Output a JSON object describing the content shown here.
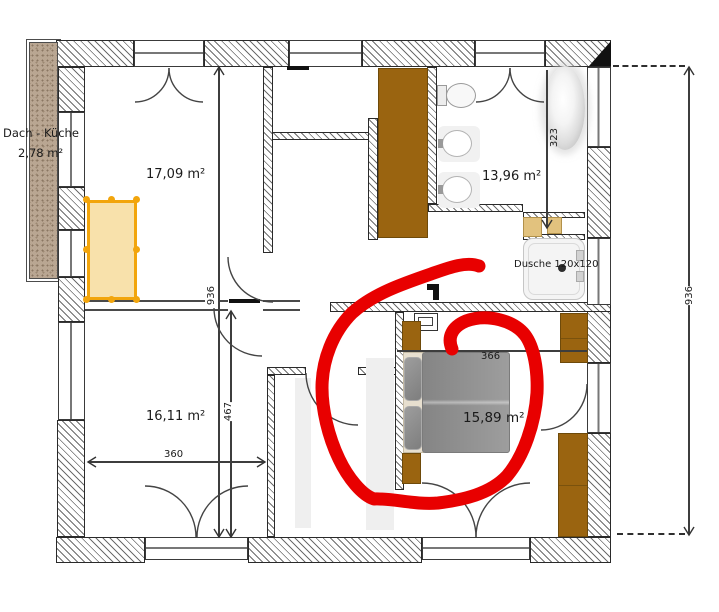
{
  "rooms": {
    "attic_label": "Dach - Küche",
    "attic_area": "2,78 m²",
    "top_left_area": "17,09 m²",
    "bottom_left_area": "16,11 m²",
    "bathroom_area": "13,96 m²",
    "bedroom_area": "15,89 m²",
    "shower_label": "Dusche 120x120"
  },
  "dims": {
    "d360": "360",
    "d467": "467",
    "d936_inner": "936",
    "d936_outer": "936",
    "d323": "323",
    "d366": "366"
  },
  "annotation": {
    "type": "freehand-circle",
    "color": "#e80000",
    "target": "bed"
  },
  "colors": {
    "wall_hatch": "#6d6d6d",
    "furniture_brown": "#9a6410",
    "selection_orange": "#f2a50c",
    "selection_fill": "#f7e1aa",
    "bed_gray": "#909090",
    "attic_fill": "#b9a692",
    "annotation_red": "#e80000"
  }
}
